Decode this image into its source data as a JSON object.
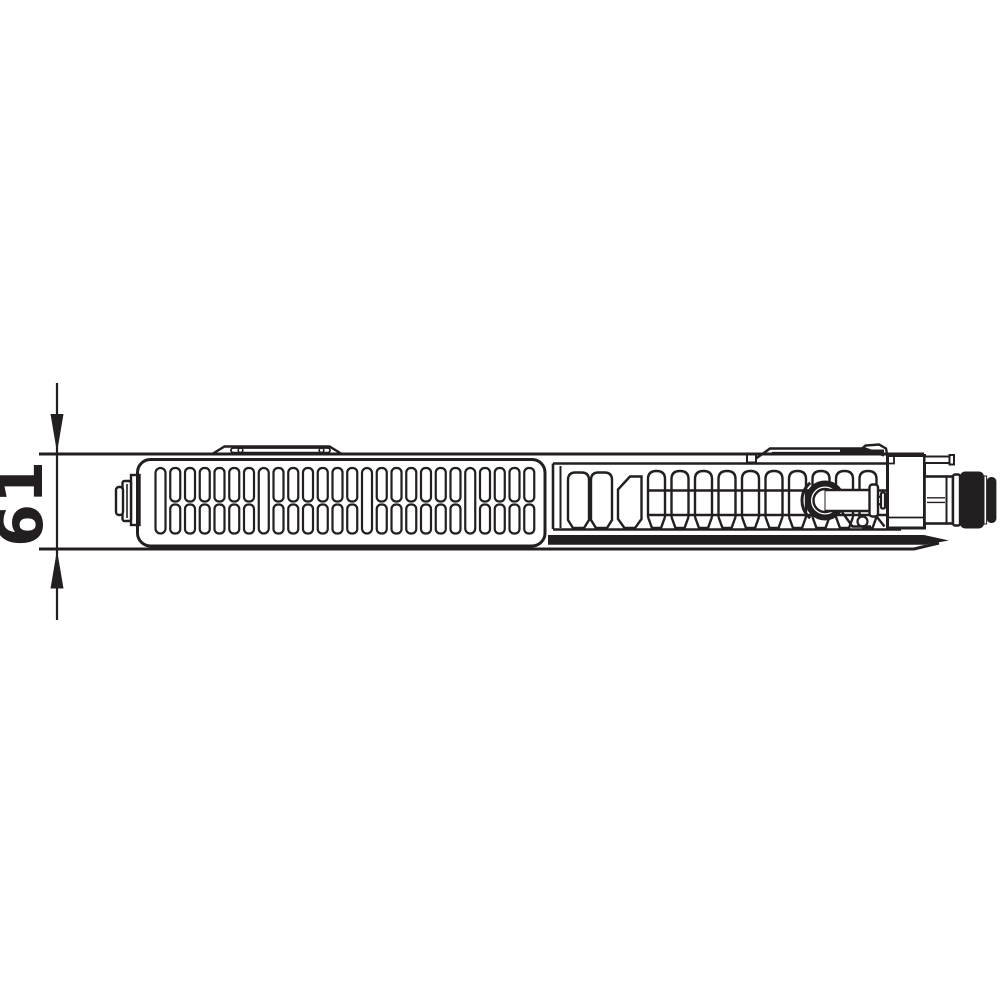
{
  "drawing": {
    "type": "technical-line-drawing",
    "subject": "panel-radiator-top-section-with-grille-valve-and-connection",
    "dimension_label": "61",
    "colors": {
      "line": "#231f20",
      "background": "#ffffff"
    },
    "grille": {
      "columns": 26,
      "full_height_every": 7,
      "start_x": 155.5,
      "pitch": 14.75,
      "slot_width": 10
    },
    "fins": {
      "channels": 10,
      "start_x": 648,
      "pitch": 23.5,
      "channel_width": 17
    }
  }
}
